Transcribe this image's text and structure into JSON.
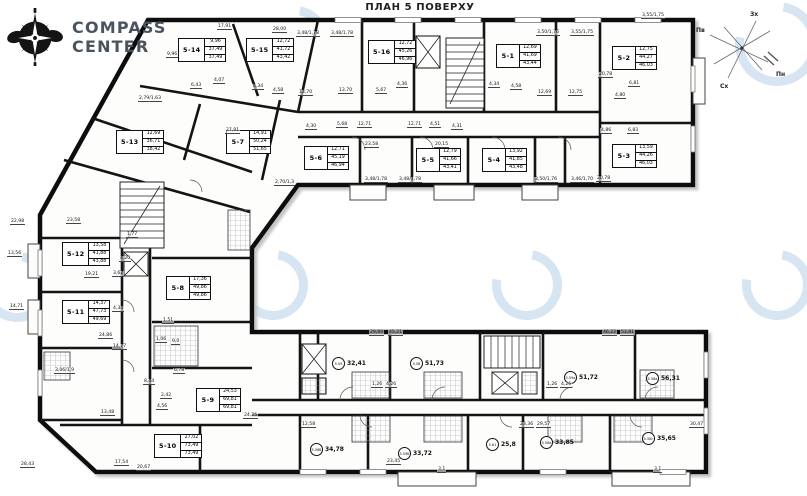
{
  "title": "ПЛАН 5 ПОВЕРХУ",
  "logo": {
    "line1": "COMPASS",
    "line2": "CENTER"
  },
  "compass": {
    "west": "Зх",
    "south": "Пв",
    "east": "Сх",
    "north": "Пн"
  },
  "apartments": [
    {
      "id": "5-14",
      "v1": "9,96",
      "v2": "37,49",
      "v3": "37,49",
      "x": 178,
      "y": 38
    },
    {
      "id": "5-15",
      "v1": "12,72",
      "v2": "41,72",
      "v3": "43,42",
      "x": 246,
      "y": 38
    },
    {
      "id": "5-16",
      "v1": "12,72",
      "v2": "45,26",
      "v3": "46,96",
      "x": 368,
      "y": 40
    },
    {
      "id": "5-1",
      "v1": "12,69",
      "v2": "41,69",
      "v3": "43,44",
      "x": 496,
      "y": 44
    },
    {
      "id": "5-2",
      "v1": "12,75",
      "v2": "44,27",
      "v3": "46,03",
      "x": 612,
      "y": 46
    },
    {
      "id": "5-3",
      "v1": "13,59",
      "v2": "44,26",
      "v3": "46,03",
      "x": 612,
      "y": 144
    },
    {
      "id": "5-4",
      "v1": "13,92",
      "v2": "41,85",
      "v3": "43,48",
      "x": 482,
      "y": 148
    },
    {
      "id": "5-5",
      "v1": "12,79",
      "v2": "41,66",
      "v3": "43,41",
      "x": 416,
      "y": 148
    },
    {
      "id": "5-6",
      "v1": "12,71",
      "v2": "45,19",
      "v3": "46,94",
      "x": 304,
      "y": 146
    },
    {
      "id": "5-7",
      "v1": "14,91",
      "v2": "50,24",
      "v3": "51,65",
      "x": 226,
      "y": 130
    },
    {
      "id": "5-13",
      "v1": "12,69",
      "v2": "36,71",
      "v3": "38,42",
      "x": 116,
      "y": 130
    },
    {
      "id": "5-12",
      "v1": "13,58",
      "v2": "41,88",
      "v3": "43,88",
      "x": 62,
      "y": 242
    },
    {
      "id": "5-11",
      "v1": "14,37",
      "v2": "47,73",
      "v3": "49,69",
      "x": 62,
      "y": 300
    },
    {
      "id": "5-8",
      "v1": "17,36",
      "v2": "49,86",
      "v3": "49,86",
      "x": 166,
      "y": 276
    },
    {
      "id": "5-9",
      "v1": "24,53",
      "v2": "69,81",
      "v3": "69,81",
      "x": 196,
      "y": 388
    },
    {
      "id": "5-10",
      "v1": "27,02",
      "v2": "73,49",
      "v3": "73,49",
      "x": 154,
      "y": 434
    }
  ],
  "commercial": [
    {
      "id": "5.59",
      "area": "32,41",
      "x": 332,
      "y": 357
    },
    {
      "id": "5.58",
      "area": "51,73",
      "x": 410,
      "y": 357
    },
    {
      "id": "5.59а",
      "area": "51,72",
      "x": 564,
      "y": 371
    },
    {
      "id": "5.58а",
      "area": "56,31",
      "x": 646,
      "y": 372
    },
    {
      "id": "5.58б",
      "area": "34,78",
      "x": 310,
      "y": 443
    },
    {
      "id": "5.59б",
      "area": "33,72",
      "x": 398,
      "y": 447
    },
    {
      "id": "5.61",
      "area": "25,8",
      "x": 486,
      "y": 438
    },
    {
      "id": "5.58в",
      "area": "33,85",
      "x": 540,
      "y": 436
    },
    {
      "id": "5.58г",
      "area": "35,65",
      "x": 642,
      "y": 432
    }
  ],
  "dimensions": [
    {
      "t": "17,91",
      "x": 217,
      "y": 24
    },
    {
      "t": "28,00",
      "x": 272,
      "y": 27
    },
    {
      "t": "3,48/1,78",
      "x": 296,
      "y": 31
    },
    {
      "t": "3,48/1,78",
      "x": 330,
      "y": 31
    },
    {
      "t": "3,50/1,76",
      "x": 536,
      "y": 30
    },
    {
      "t": "3,55/1,75",
      "x": 570,
      "y": 30
    },
    {
      "t": "3,55/1,75",
      "x": 641,
      "y": 13
    },
    {
      "t": "9,96",
      "x": 166,
      "y": 52
    },
    {
      "t": "6,43",
      "x": 190,
      "y": 83
    },
    {
      "t": "4,07",
      "x": 213,
      "y": 78
    },
    {
      "t": "4,34",
      "x": 252,
      "y": 84
    },
    {
      "t": "4,58",
      "x": 272,
      "y": 88
    },
    {
      "t": "13,70",
      "x": 298,
      "y": 90
    },
    {
      "t": "13,70",
      "x": 338,
      "y": 88
    },
    {
      "t": "5,67",
      "x": 375,
      "y": 88
    },
    {
      "t": "4,36",
      "x": 396,
      "y": 82
    },
    {
      "t": "4,34",
      "x": 488,
      "y": 82
    },
    {
      "t": "4,58",
      "x": 510,
      "y": 84
    },
    {
      "t": "12,69",
      "x": 537,
      "y": 90
    },
    {
      "t": "12,75",
      "x": 568,
      "y": 90
    },
    {
      "t": "20,78",
      "x": 598,
      "y": 72
    },
    {
      "t": "6,81",
      "x": 628,
      "y": 81
    },
    {
      "t": "4,80",
      "x": 614,
      "y": 93
    },
    {
      "t": "4,86",
      "x": 600,
      "y": 128
    },
    {
      "t": "6,83",
      "x": 627,
      "y": 128
    },
    {
      "t": "20,78",
      "x": 596,
      "y": 176
    },
    {
      "t": "4,30",
      "x": 305,
      "y": 124
    },
    {
      "t": "5,68",
      "x": 336,
      "y": 122
    },
    {
      "t": "12,71",
      "x": 357,
      "y": 122
    },
    {
      "t": "12,71",
      "x": 407,
      "y": 122
    },
    {
      "t": "4,51",
      "x": 429,
      "y": 122
    },
    {
      "t": "4,31",
      "x": 451,
      "y": 124
    },
    {
      "t": "23,58",
      "x": 364,
      "y": 142
    },
    {
      "t": "20,15",
      "x": 434,
      "y": 142
    },
    {
      "t": "3,48/1,78",
      "x": 364,
      "y": 177
    },
    {
      "t": "3,48/1,78",
      "x": 398,
      "y": 177
    },
    {
      "t": "3,50/1,76",
      "x": 534,
      "y": 177
    },
    {
      "t": "3,46/1,70",
      "x": 570,
      "y": 177
    },
    {
      "t": "2,70/1,3",
      "x": 274,
      "y": 180
    },
    {
      "t": "27,91",
      "x": 225,
      "y": 128
    },
    {
      "t": "2,79/1,63",
      "x": 138,
      "y": 96
    },
    {
      "t": "23,58",
      "x": 66,
      "y": 218
    },
    {
      "t": "1,77",
      "x": 126,
      "y": 232
    },
    {
      "t": "4,20",
      "x": 119,
      "y": 256
    },
    {
      "t": "3,62",
      "x": 112,
      "y": 271
    },
    {
      "t": "19,21",
      "x": 84,
      "y": 272
    },
    {
      "t": "4,34",
      "x": 112,
      "y": 306
    },
    {
      "t": "1,51",
      "x": 162,
      "y": 318
    },
    {
      "t": "1,06",
      "x": 155,
      "y": 337
    },
    {
      "t": "9,0",
      "x": 171,
      "y": 339
    },
    {
      "t": "6,78",
      "x": 173,
      "y": 368
    },
    {
      "t": "8,44",
      "x": 143,
      "y": 379
    },
    {
      "t": "2,42",
      "x": 160,
      "y": 393
    },
    {
      "t": "4,56",
      "x": 156,
      "y": 404
    },
    {
      "t": "24,25",
      "x": 243,
      "y": 413
    },
    {
      "t": "24,86",
      "x": 98,
      "y": 333
    },
    {
      "t": "14,77",
      "x": 112,
      "y": 344
    },
    {
      "t": "3,06/1,9",
      "x": 54,
      "y": 368
    },
    {
      "t": "13,48",
      "x": 100,
      "y": 410
    },
    {
      "t": "17,54",
      "x": 114,
      "y": 460
    },
    {
      "t": "20,67",
      "x": 136,
      "y": 465
    },
    {
      "t": "28,43",
      "x": 20,
      "y": 462
    },
    {
      "t": "29,89",
      "x": 369,
      "y": 330
    },
    {
      "t": "45,21",
      "x": 388,
      "y": 330
    },
    {
      "t": "46,22",
      "x": 602,
      "y": 330
    },
    {
      "t": "53,81",
      "x": 620,
      "y": 330
    },
    {
      "t": "12,58",
      "x": 301,
      "y": 422
    },
    {
      "t": "23,36",
      "x": 519,
      "y": 422
    },
    {
      "t": "29,57",
      "x": 536,
      "y": 422
    },
    {
      "t": "30,47",
      "x": 689,
      "y": 422
    },
    {
      "t": "23,45",
      "x": 386,
      "y": 459
    },
    {
      "t": "3,1",
      "x": 437,
      "y": 467
    },
    {
      "t": "3,1",
      "x": 653,
      "y": 467
    },
    {
      "t": "22,98",
      "x": 10,
      "y": 219
    },
    {
      "t": "13,56",
      "x": 7,
      "y": 251
    },
    {
      "t": "14,71",
      "x": 9,
      "y": 304
    },
    {
      "t": "1,26",
      "x": 371,
      "y": 382
    },
    {
      "t": "4,26",
      "x": 385,
      "y": 382
    },
    {
      "t": "1,26",
      "x": 546,
      "y": 382
    },
    {
      "t": "4,26",
      "x": 560,
      "y": 382
    }
  ]
}
